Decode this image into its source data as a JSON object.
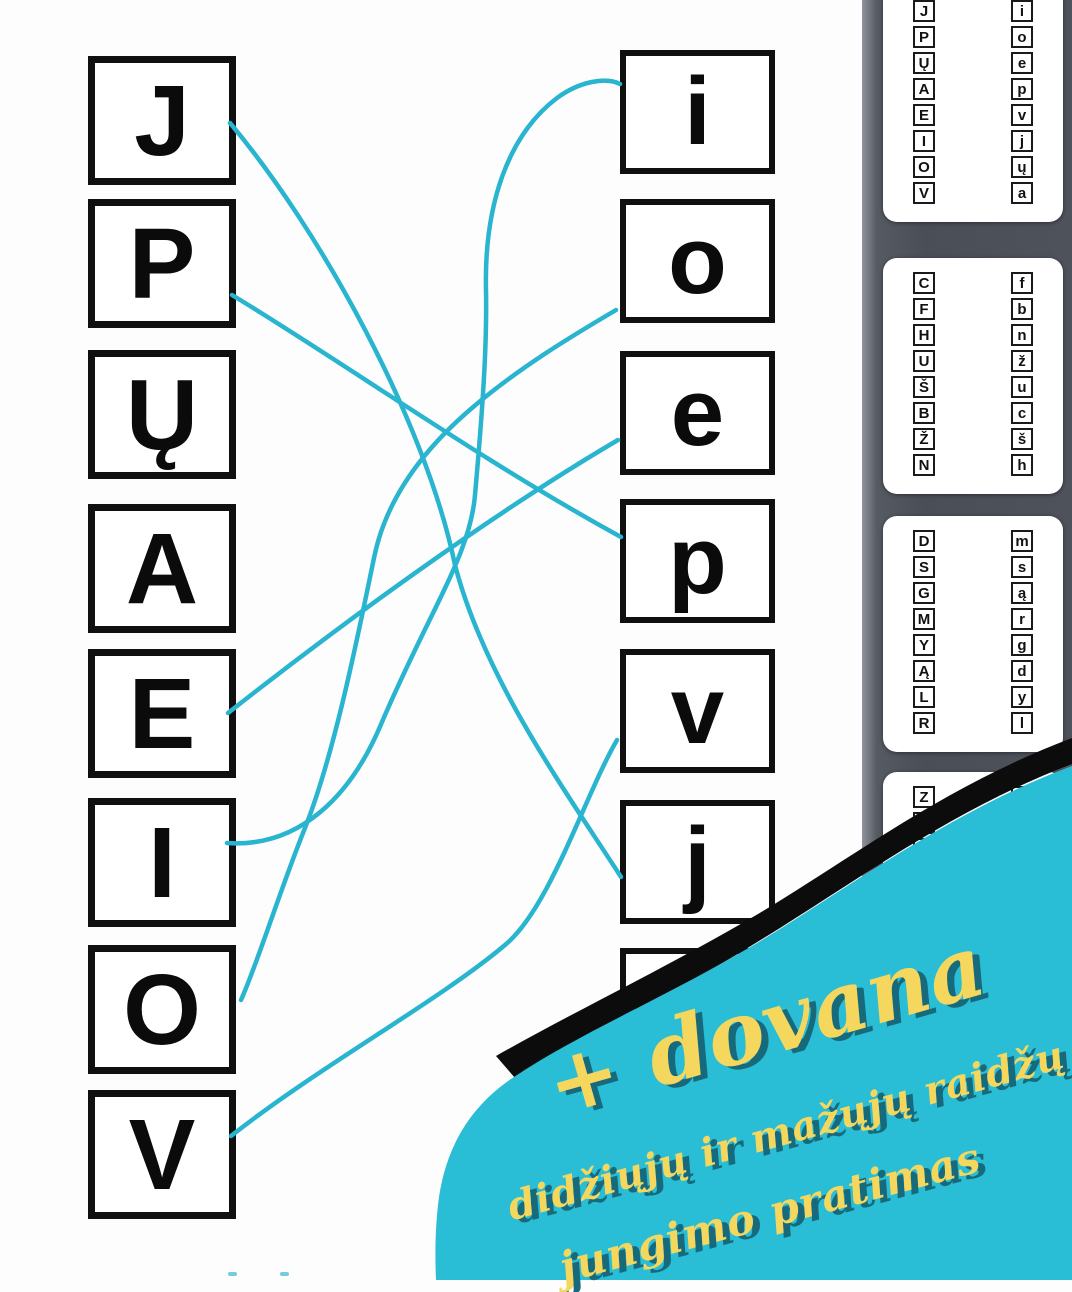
{
  "worksheet": {
    "left_column": [
      "J",
      "P",
      "Ų",
      "A",
      "E",
      "I",
      "O",
      "V"
    ],
    "right_column": [
      "i",
      "o",
      "e",
      "p",
      "v",
      "j",
      ""
    ],
    "line_color": "#29b4cf",
    "connections": [
      {
        "from": "J",
        "to": "j",
        "path": "M 230,123 C 320,230 425,420 455,565 C 485,680 565,790 621,877"
      },
      {
        "from": "P",
        "to": "p",
        "path": "M 232,295 C 340,360 480,460 621,537"
      },
      {
        "from": "E",
        "to": "e",
        "path": "M 228,713 C 340,625 490,515 618,440"
      },
      {
        "from": "I",
        "to": "i",
        "path": "M 227,843 C 300,848 352,795 382,722 C 430,610 470,555 475,495 C 483,405 487,345 486,290 C 484,205 508,135 557,98 C 580,81 606,77 620,84"
      },
      {
        "from": "O",
        "to": "o",
        "path": "M 241,1000 C 258,962 280,890 305,828 C 335,752 358,635 374,558 C 386,498 425,448 472,408 C 520,367 572,336 616,310"
      },
      {
        "from": "V",
        "to": "v",
        "path": "M 231,1136 C 320,1066 440,1000 505,945 C 550,908 585,795 617,740"
      }
    ]
  },
  "sidebar": {
    "pages": [
      {
        "left": [
          "J",
          "P",
          "Ų",
          "A",
          "E",
          "I",
          "O",
          "V"
        ],
        "right": [
          "i",
          "o",
          "e",
          "p",
          "v",
          "j",
          "ų",
          "a"
        ]
      },
      {
        "left": [
          "C",
          "F",
          "H",
          "U",
          "Š",
          "B",
          "Ž",
          "N"
        ],
        "right": [
          "f",
          "b",
          "n",
          "ž",
          "u",
          "c",
          "š",
          "h"
        ]
      },
      {
        "left": [
          "D",
          "S",
          "G",
          "M",
          "Y",
          "Ą",
          "L",
          "R"
        ],
        "right": [
          "m",
          "s",
          "ą",
          "r",
          "g",
          "d",
          "y",
          "l"
        ]
      },
      {
        "left": [
          "Z",
          "Č",
          "",
          "",
          "",
          "",
          "",
          ""
        ],
        "right": [
          "",
          "",
          "",
          "",
          "",
          "",
          "",
          ""
        ]
      }
    ]
  },
  "promo": {
    "headline": "+ dovana",
    "subline1": "didžiųjų ir mažųjų raidžų",
    "subline2": "jungimo pratimas",
    "blob_color": "#2abdd6",
    "text_color": "#f6d75e",
    "shadow_color": "#176a7b"
  }
}
